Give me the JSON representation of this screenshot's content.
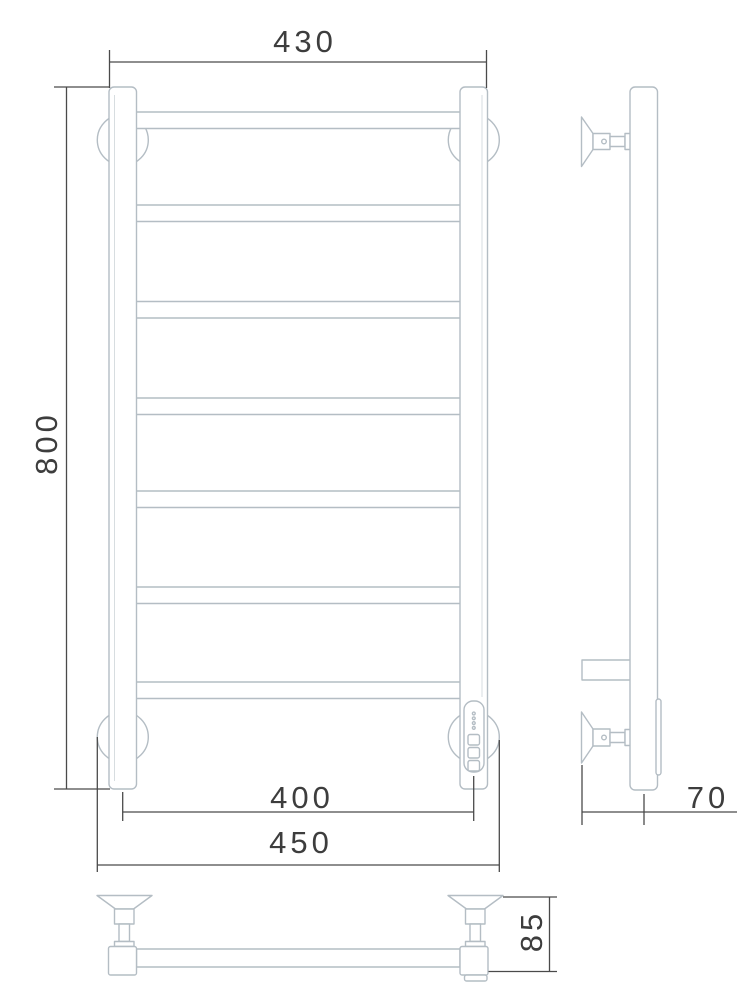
{
  "drawing": {
    "subject": "heated towel rail ladder - orthographic technical drawing (front, side, top views)",
    "colors": {
      "product_line": "#b4bdc4",
      "dimension_line": "#4a4a4a",
      "text": "#3d3d3d",
      "background": "#ffffff"
    },
    "dimensions": {
      "top_width": "430",
      "height": "800",
      "bottom_bracket_span": "400",
      "overall_width": "450",
      "wall_depth": "70",
      "bracket_depth": "85"
    },
    "front_view": {
      "rung_count": 7,
      "rung_x": 136,
      "rung_width": 324.5,
      "rung_height": 16.5,
      "rung_y_tops": [
        112,
        205,
        301.5,
        398,
        491,
        587,
        682
      ],
      "post_count": 2,
      "wall_flange_count": 4,
      "panel_led_count": 4,
      "panel_button_count": 3
    }
  }
}
